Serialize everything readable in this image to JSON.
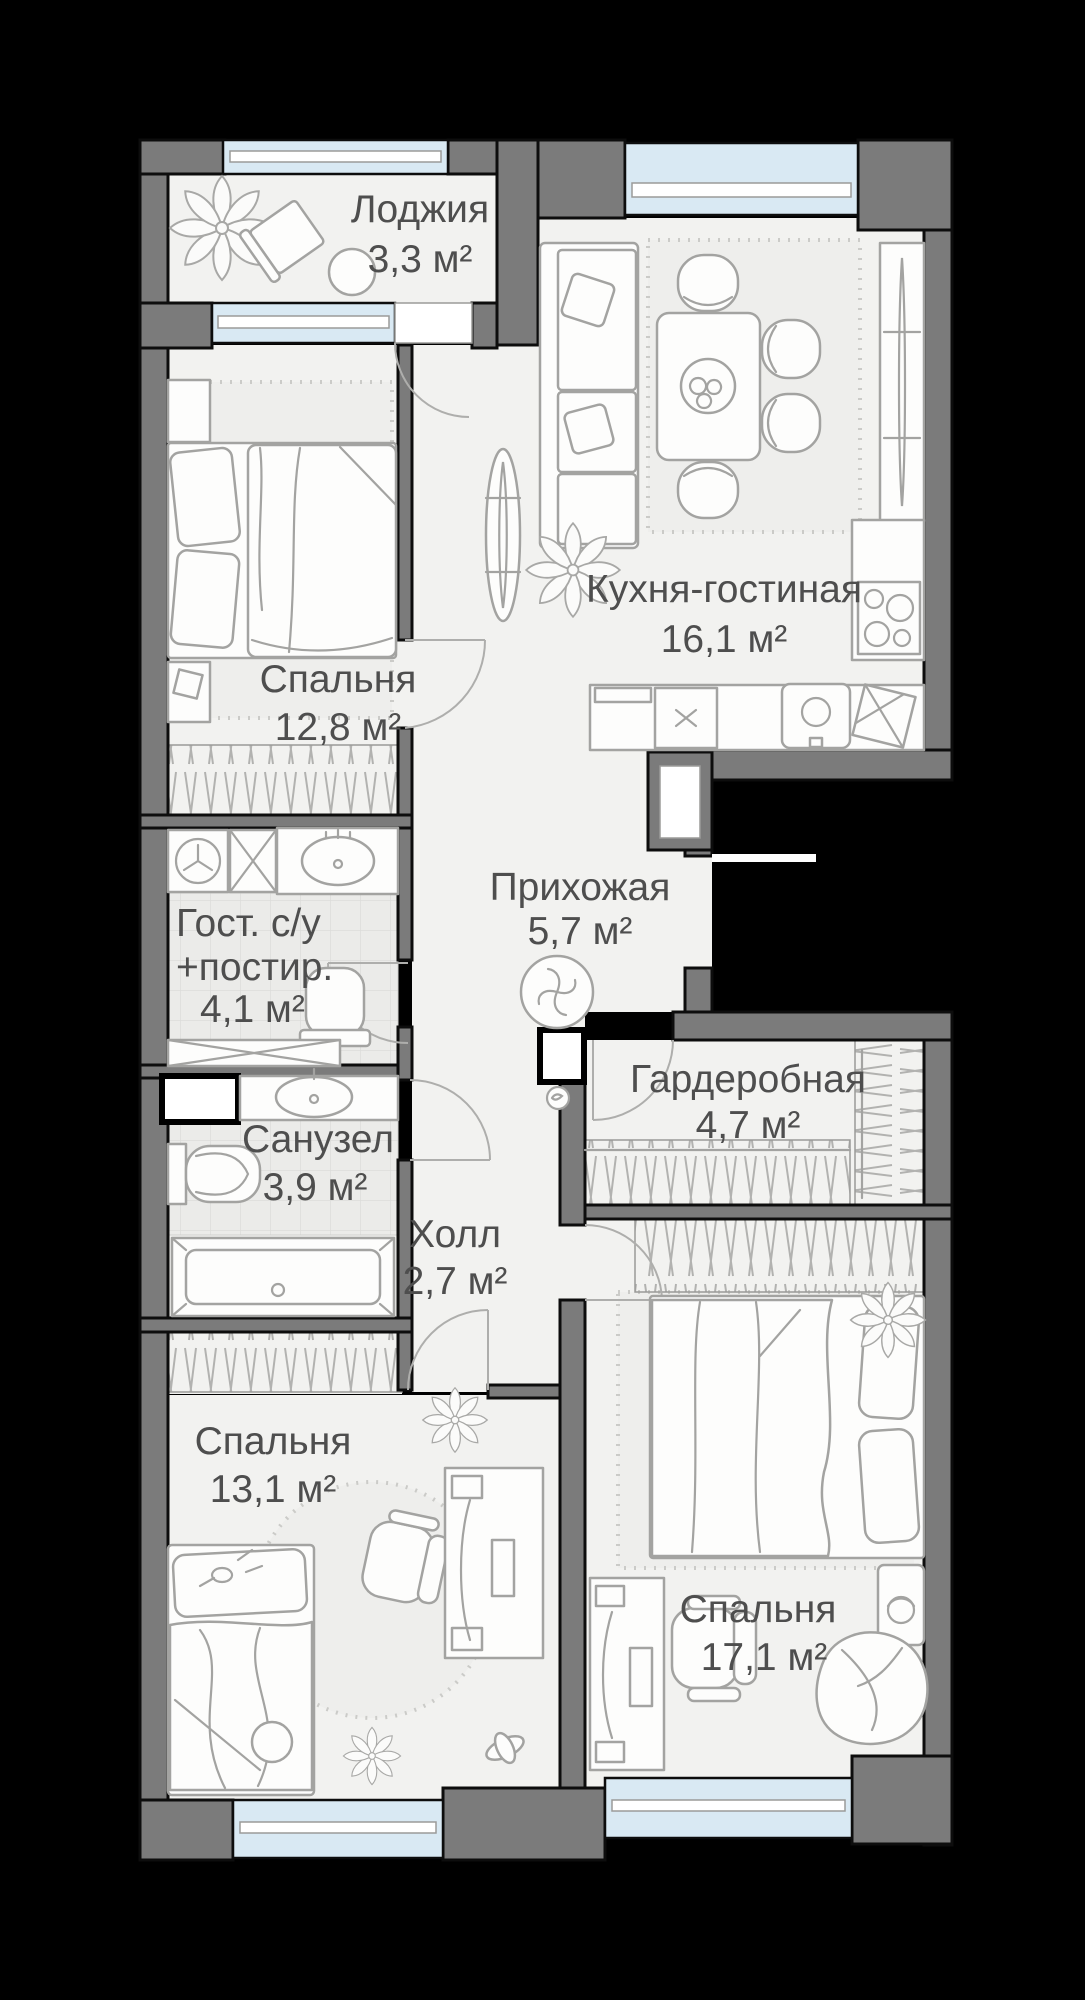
{
  "plan_title": "apartment-floor-plan",
  "rooms": {
    "loggia": {
      "name": "Лоджия",
      "area": "3,3 м²"
    },
    "kitchen": {
      "name": "Кухня-гостиная",
      "area": "16,1 м²"
    },
    "bedroom1": {
      "name": "Спальня",
      "area": "12,8 м²"
    },
    "guest_wc": {
      "name_line1": "Гост. с/у",
      "name_line2": "+постир.",
      "area": "4,1 м²"
    },
    "hallway": {
      "name": "Прихожая",
      "area": "5,7 м²"
    },
    "bathroom": {
      "name": "Санузел",
      "area": "3,9 м²"
    },
    "wardrobe": {
      "name": "Гардеробная",
      "area": "4,7 м²"
    },
    "hall": {
      "name": "Холл",
      "area": "2,7 м²"
    },
    "bedroom2": {
      "name": "Спальня",
      "area": "13,1 м²"
    },
    "bedroom3": {
      "name": "Спальня",
      "area": "17,1 м²"
    }
  },
  "colors": {
    "wall": "#7b7b7b",
    "floor": "#f2f2f0",
    "window": "#d9e9f3",
    "label": "#4e4e4e",
    "fstroke": "#a3a3a1",
    "outside": "#000000"
  }
}
